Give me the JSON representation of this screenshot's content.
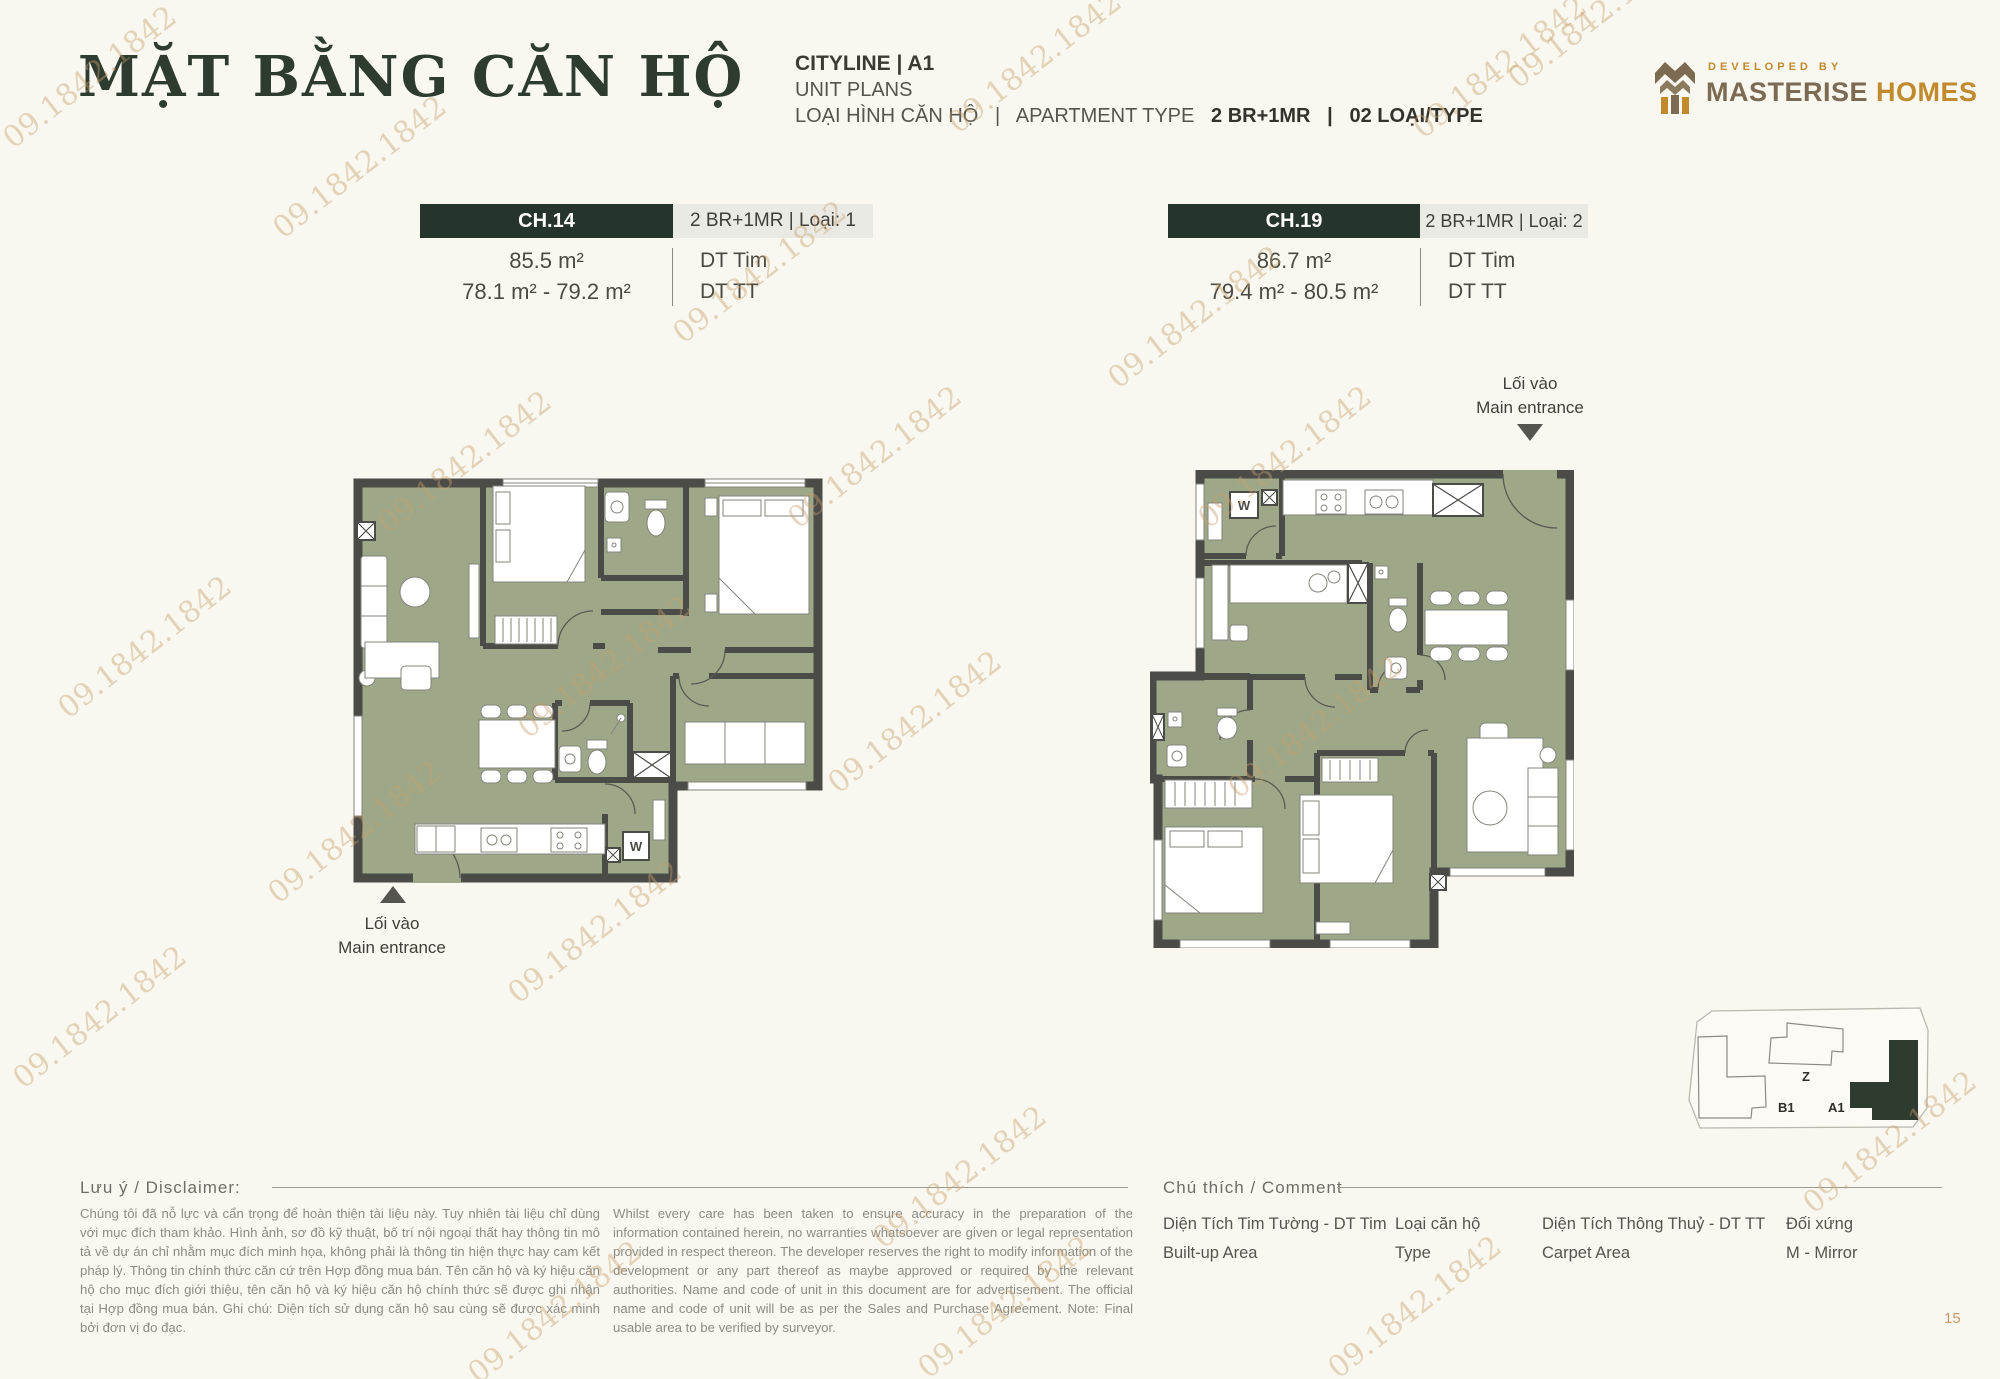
{
  "header": {
    "title": "MẶT BẰNG CĂN HỘ",
    "project": "CITYLINE | A1",
    "subtitle": "UNIT PLANS",
    "type_prefix": "LOẠI HÌNH CĂN HỘ   |   APARTMENT TYPE   ",
    "type_value": "2 BR+1MR   |   02 LOẠI/TYPE"
  },
  "logo": {
    "developed_by": "DEVELOPED BY",
    "brand_primary": "MASTERISE",
    "brand_secondary": "HOMES"
  },
  "units": [
    {
      "code": "CH.14",
      "type_label": "2 BR+1MR | Loại: 1",
      "built_up_area": "85.5 m²",
      "carpet_area": "78.1 m² - 79.2 m²",
      "built_up_label": "DT Tim",
      "carpet_label": "DT TT",
      "entrance_vi": "Lối vào",
      "entrance_en": "Main entrance"
    },
    {
      "code": "CH.19",
      "type_label": "2 BR+1MR | Loại: 2",
      "built_up_area": "86.7 m²",
      "carpet_area": "79.4 m² - 80.5 m²",
      "built_up_label": "DT Tim",
      "carpet_label": "DT TT",
      "entrance_vi": "Lối vào",
      "entrance_en": "Main entrance"
    }
  ],
  "plans": {
    "washer_label": "W"
  },
  "locator": {
    "buildings": [
      "B1",
      "Z",
      "A1"
    ],
    "highlighted": "A1"
  },
  "disclaimer": {
    "heading": "Lưu ý / Disclaimer:",
    "vietnamese": "Chúng tôi đã nỗ lực và cẩn trọng để hoàn thiện tài liệu này. Tuy nhiên tài liệu chỉ dùng với mục đích tham khảo. Hình ảnh, sơ đồ kỹ thuật, bố trí nội ngoại thất hay thông tin mô tả về dự án chỉ nhằm mục đích minh họa, không phải là thông tin hiện thực hay cam kết pháp lý. Thông tin chính thức căn cứ trên Hợp đồng mua bán. Tên căn hộ và ký hiệu căn hộ cho mục đích giới thiệu, tên căn hộ và ký hiệu căn hộ chính thức sẽ được ghi nhận tại Hợp đồng mua bán. Ghi chú: Diện tích sử dụng căn hộ sau cùng sẽ được xác minh bởi đơn vị đo đạc.",
    "english": "Whilst every care has been taken to ensure accuracy in the preparation of the information contained herein, no warranties whatsoever are given or legal representation provided in respect thereon. The developer reserves the right to modify information of the development or any part thereof as maybe approved or required by the relevant authorities. Name and code of unit in this document are for advertisement. The official name and code of unit will be as per the Sales and Purchase Agreement. Note: Final usable area to be verified by surveyor."
  },
  "legend": {
    "heading": "Chú thích / Comment",
    "items": [
      {
        "vi": "Diện Tích Tim Tường - DT Tim",
        "en": "Built-up Area"
      },
      {
        "vi": "Loại căn hộ",
        "en": "Type"
      },
      {
        "vi": "Diện Tích Thông Thuỷ - DT TT",
        "en": "Carpet Area"
      },
      {
        "vi": "Đối xứng",
        "en": "M - Mirror"
      }
    ]
  },
  "page_number": "15",
  "watermark": {
    "text": "09.1842.1842"
  },
  "colors": {
    "background": "#F8F7F0",
    "accent_green": "#26352B",
    "floor": "#9EA888",
    "wall": "#4B4B48",
    "gold": "#C49A6A"
  }
}
